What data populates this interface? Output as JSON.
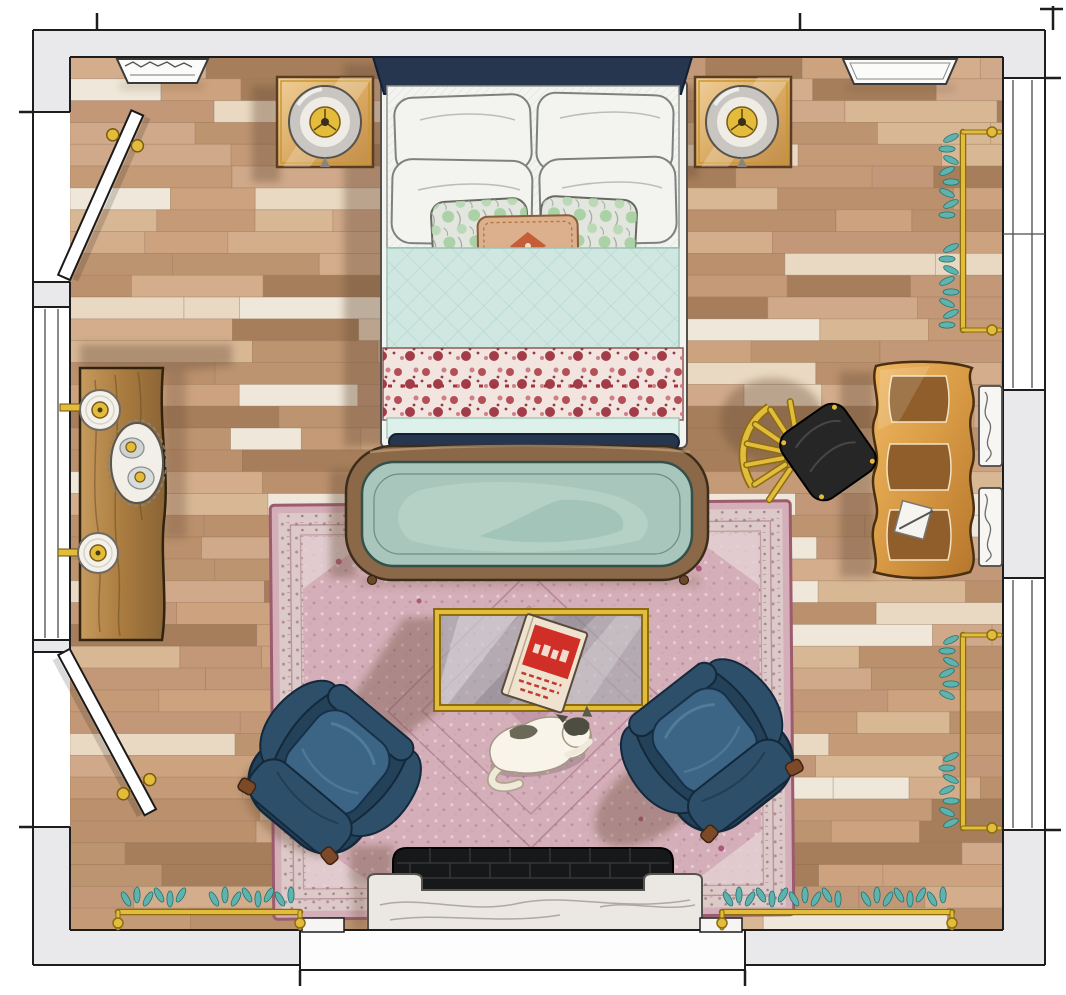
{
  "scene": {
    "kind": "hand-rendered top-down bedroom floor plan illustration",
    "room": "bedroom with fireplace, two doors, windows on left and right walls"
  },
  "palette": {
    "wall": "#e9e8ea",
    "ink": "#1d1d1d",
    "gold": "#e3bc3c",
    "goldD": "#8a6d10",
    "navy": "#27364f",
    "bedW": "#f3f4f0",
    "quilt": "#cfe7e0",
    "blanketB": "#f2e4de",
    "blanketR": "#ab3f4b",
    "rugF": "#d4aeb8",
    "rugB": "#dccac9",
    "rugE": "#9c5c6e",
    "benchW": "#8a6848",
    "benchC": "#a8c6bb",
    "chair": "#2d4f69",
    "chairD": "#24415a",
    "chairL": "#3c6484",
    "glass": "#b9c2c6",
    "deskW": "#d89a44",
    "deskP": "#8f5e2b",
    "seatB": "#262626",
    "leaf": "#5fb3ae",
    "leafD": "#256f6c",
    "marble": "#ebe7e2",
    "firebox": "#17181a",
    "door": "#ffffff",
    "consoleW": "#b08049",
    "nightstandW": "#e2b878",
    "catF": "#f8f4ea",
    "catP": "#52513f",
    "lumbar": "#dcb08c",
    "accent": "#a5cfa0",
    "shadow": "#6a5038",
    "floor_grout": "#8b6a4c",
    "floor_planks": {
      "base": [
        "#cfa98a",
        "#c49a77",
        "#d8b795",
        "#ba906d",
        "#cda37f",
        "#c29878",
        "#d3ad8c",
        "#bd9470"
      ],
      "light": "#ead9c2",
      "pale": "#efe7d9",
      "dark": "#a67e5b"
    }
  },
  "items": [
    {
      "id": "bed",
      "label": "double bed with navy headboard, white pillows, teal quilt and red floral blanket"
    },
    {
      "id": "nightstand-left",
      "label": "square wood nightstand with round lamp"
    },
    {
      "id": "nightstand-right",
      "label": "square wood nightstand with round lamp"
    },
    {
      "id": "wall-shelf-left",
      "label": "carved white wall shelf on top wall"
    },
    {
      "id": "wall-shelf-right",
      "label": "white wall shelf on top wall"
    },
    {
      "id": "door-upper-left",
      "label": "open door, upper left wall"
    },
    {
      "id": "door-lower-left",
      "label": "open door, lower left wall"
    },
    {
      "id": "console-table",
      "label": "wood console with two sconce lamps and decanter tray"
    },
    {
      "id": "bench",
      "label": "bentwood bench with seafoam cushion at foot of bed"
    },
    {
      "id": "area-rug",
      "label": "dusty pink persian rug"
    },
    {
      "id": "coffee-table",
      "label": "gold framed glass coffee table"
    },
    {
      "id": "book",
      "label": "red and cream book on coffee table"
    },
    {
      "id": "armchair-left",
      "label": "navy wingback armchair"
    },
    {
      "id": "armchair-right",
      "label": "navy wingback armchair"
    },
    {
      "id": "cat",
      "label": "white cat with dark patches lying on rug"
    },
    {
      "id": "desk",
      "label": "curved amber wood desk with notepad"
    },
    {
      "id": "desk-chair",
      "label": "black chair with gold fan back"
    },
    {
      "id": "fireplace",
      "label": "black brick firebox with marble hearth"
    },
    {
      "id": "radiators",
      "label": "brass rails with teal foliage along right and bottom walls"
    },
    {
      "id": "wall-brackets",
      "label": "two carved white brackets on right wall"
    }
  ]
}
